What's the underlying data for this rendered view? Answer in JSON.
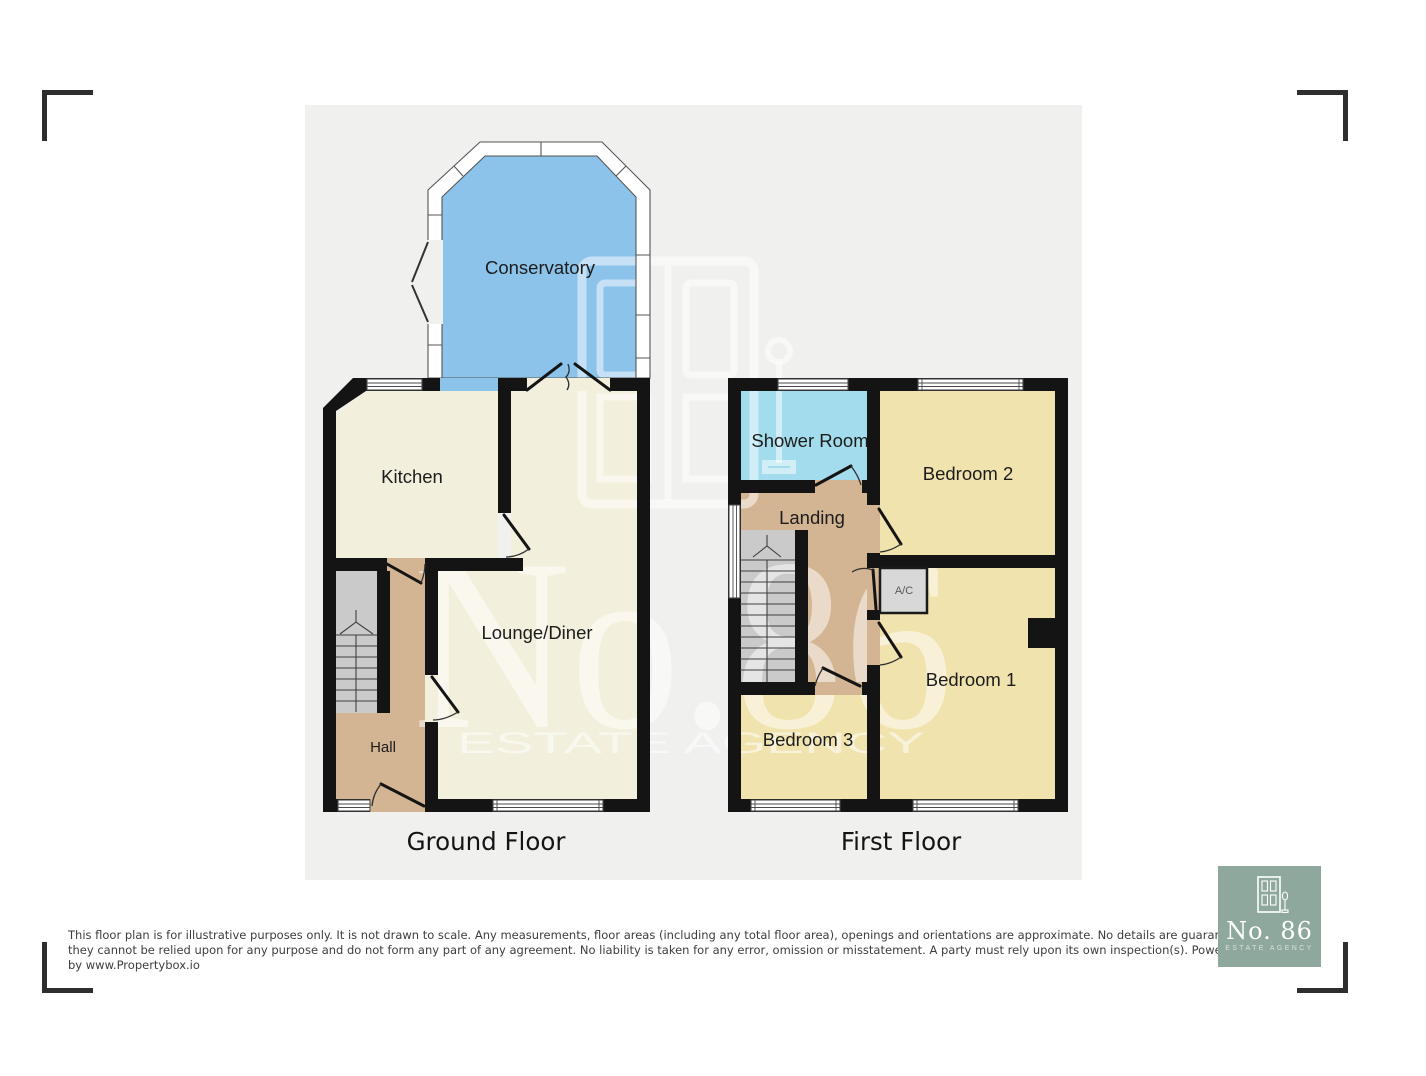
{
  "plan": {
    "panel_bg": "#f0f0ef",
    "wall_color": "#141414",
    "floor_titles": {
      "ground": "Ground Floor",
      "first": "First Floor"
    },
    "rooms": {
      "conservatory": "Conservatory",
      "kitchen": "Kitchen",
      "lounge": "Lounge/Diner",
      "hall": "Hall",
      "shower": "Shower Room",
      "landing": "Landing",
      "bedroom2": "Bedroom 2",
      "bedroom1": "Bedroom 1",
      "bedroom3": "Bedroom 3",
      "ac": "A/C"
    },
    "room_colors": {
      "conservatory": "#8cc3eb",
      "kitchen": "#f2efdc",
      "lounge": "#f2efdc",
      "hall": "#d3b493",
      "shower": "#a3dcec",
      "landing": "#d3b493",
      "bedroom": "#f0e3ae",
      "stairs": "#cacaca",
      "ac": "#d8d8d8"
    }
  },
  "watermark": {
    "brand": "No.86",
    "tagline": "ESTATE AGENCY"
  },
  "disclaimer": {
    "line1": "This floor plan is for illustrative purposes only. It is not drawn to scale. Any measurements, floor areas (including any total floor area), openings and orientations are approximate. No details are guaranteed,",
    "line2": "they cannot be relied upon for any purpose and do not form any part of any agreement. No liability is taken for any error, omission or misstatement. A party must rely upon its own inspection(s). Powered",
    "line3": "by www.Propertybox.io"
  },
  "logo": {
    "name": "No. 86",
    "tagline": "ESTATE AGENCY",
    "bg_color": "#8ea89d"
  }
}
